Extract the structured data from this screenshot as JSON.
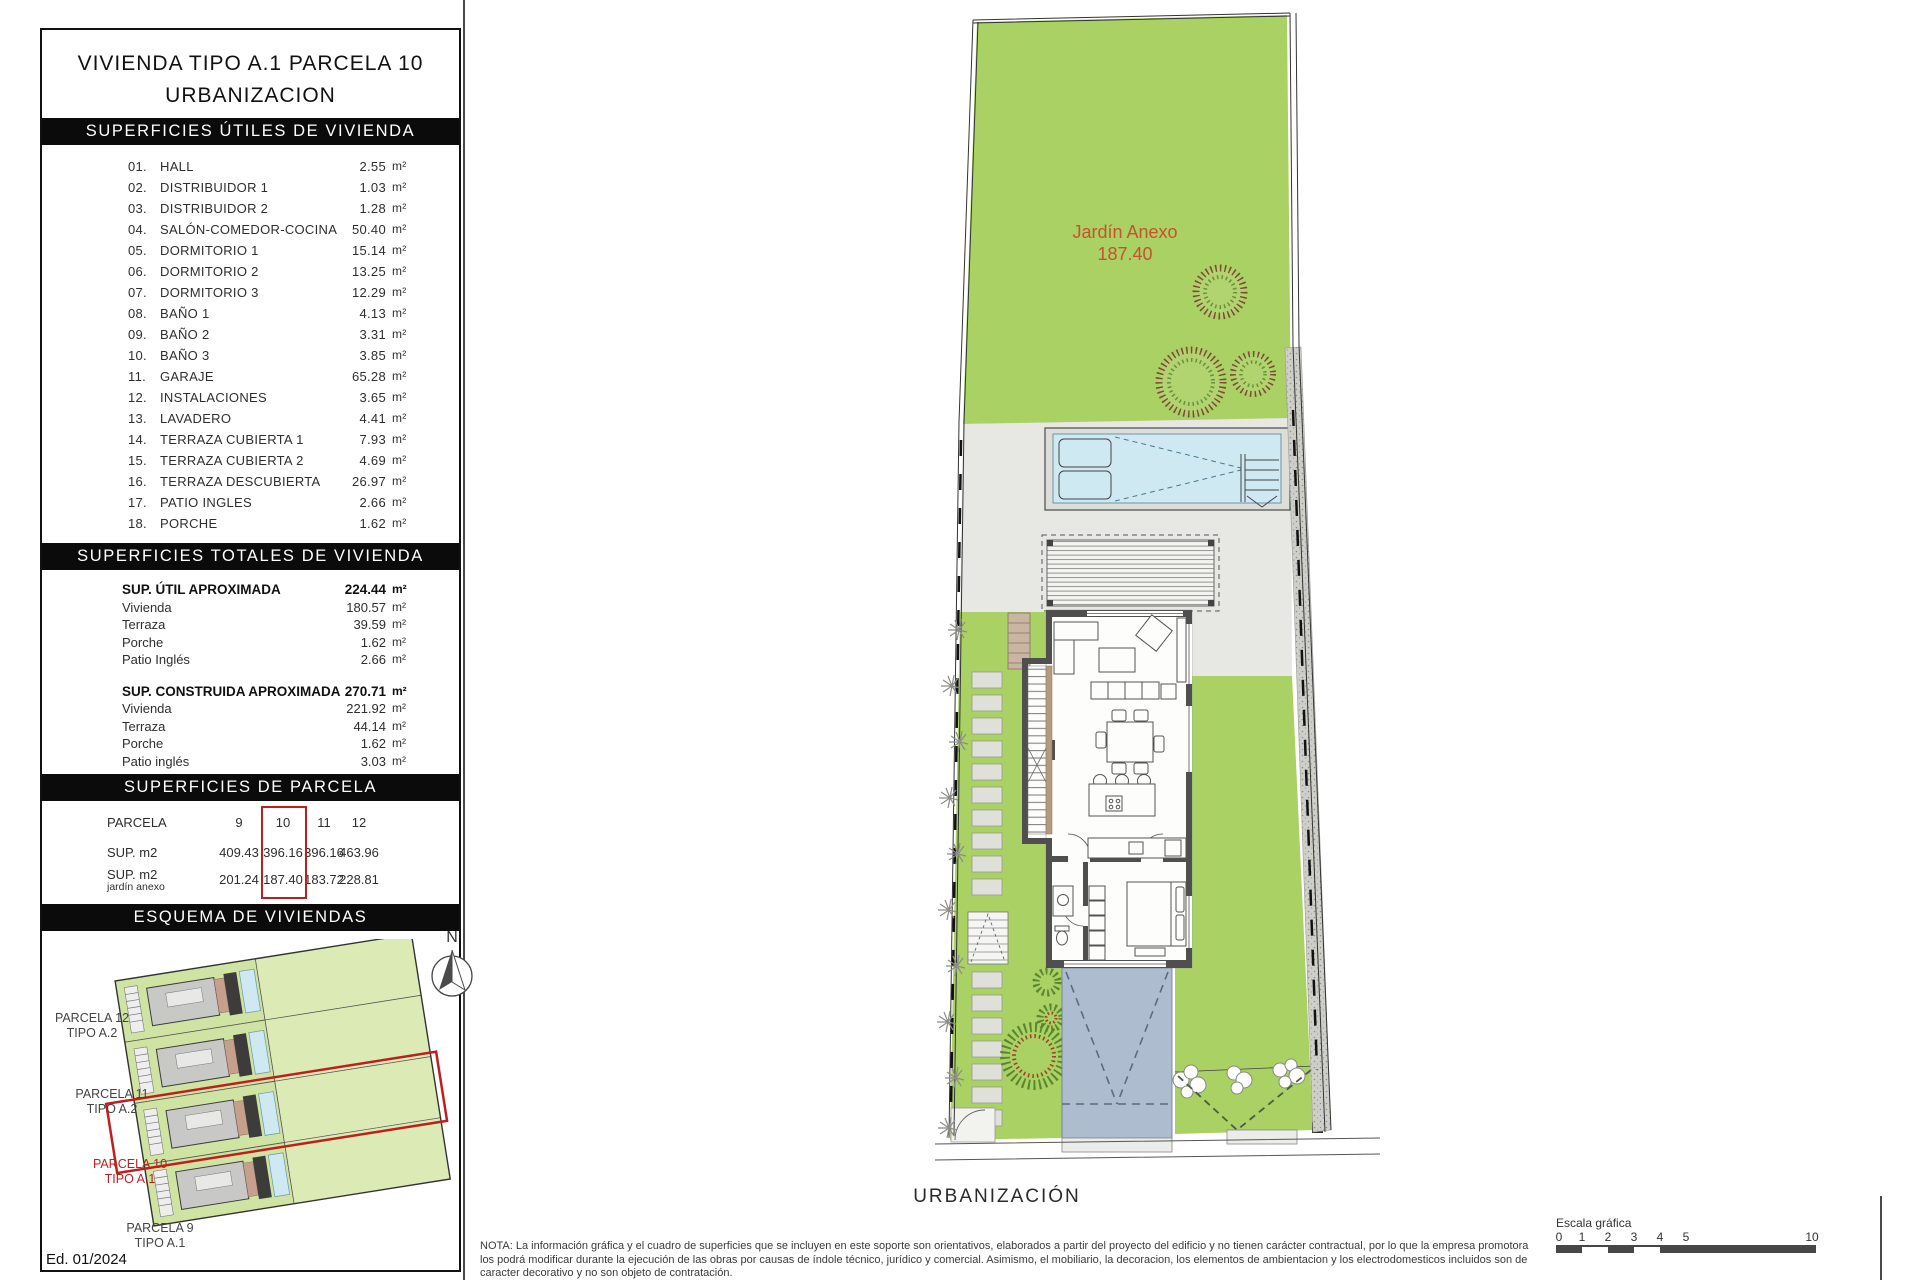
{
  "title": {
    "line1": "VIVIENDA TIPO A.1 PARCELA 10",
    "line2": "URBANIZACION"
  },
  "units": {
    "m2": "m²"
  },
  "utiles": {
    "header": "SUPERFICIES ÚTILES DE VIVIENDA",
    "rows": [
      {
        "num": "01.",
        "label": "HALL",
        "value": "2.55"
      },
      {
        "num": "02.",
        "label": "DISTRIBUIDOR 1",
        "value": "1.03"
      },
      {
        "num": "03.",
        "label": "DISTRIBUIDOR 2",
        "value": "1.28"
      },
      {
        "num": "04.",
        "label": "SALÓN-COMEDOR-COCINA",
        "value": "50.40"
      },
      {
        "num": "05.",
        "label": "DORMITORIO 1",
        "value": "15.14"
      },
      {
        "num": "06.",
        "label": "DORMITORIO 2",
        "value": "13.25"
      },
      {
        "num": "07.",
        "label": "DORMITORIO 3",
        "value": "12.29"
      },
      {
        "num": "08.",
        "label": "BAÑO 1",
        "value": "4.13"
      },
      {
        "num": "09.",
        "label": "BAÑO 2",
        "value": "3.31"
      },
      {
        "num": "10.",
        "label": "BAÑO 3",
        "value": "3.85"
      },
      {
        "num": "11.",
        "label": "GARAJE",
        "value": "65.28"
      },
      {
        "num": "12.",
        "label": "INSTALACIONES",
        "value": "3.65"
      },
      {
        "num": "13.",
        "label": "LAVADERO",
        "value": "4.41"
      },
      {
        "num": "14.",
        "label": "TERRAZA CUBIERTA 1",
        "value": "7.93"
      },
      {
        "num": "15.",
        "label": "TERRAZA CUBIERTA 2",
        "value": "4.69"
      },
      {
        "num": "16.",
        "label": "TERRAZA DESCUBIERTA",
        "value": "26.97"
      },
      {
        "num": "17.",
        "label": "PATIO INGLES",
        "value": "2.66"
      },
      {
        "num": "18.",
        "label": "PORCHE",
        "value": "1.62"
      }
    ]
  },
  "totales": {
    "header": "SUPERFICIES TOTALES DE VIVIENDA",
    "groups": [
      {
        "title": "SUP. ÚTIL APROXIMADA",
        "total": "224.44",
        "rows": [
          {
            "label": "Vivienda",
            "value": "180.57"
          },
          {
            "label": "Terraza",
            "value": "39.59"
          },
          {
            "label": "Porche",
            "value": "1.62"
          },
          {
            "label": "Patio Inglés",
            "value": "2.66"
          }
        ]
      },
      {
        "title": "SUP. CONSTRUIDA APROXIMADA",
        "total": "270.71",
        "rows": [
          {
            "label": "Vivienda",
            "value": "221.92"
          },
          {
            "label": "Terraza",
            "value": "44.14"
          },
          {
            "label": "Porche",
            "value": "1.62"
          },
          {
            "label": "Patio inglés",
            "value": "3.03"
          }
        ]
      }
    ]
  },
  "parcela": {
    "header": "SUPERFICIES DE PARCELA",
    "col_label": "PARCELA",
    "columns": [
      "9",
      "10",
      "11",
      "12"
    ],
    "row1_label": "SUP. m2",
    "row1": [
      "409.43",
      "396.16",
      "396.16",
      "463.96"
    ],
    "row2_label": "SUP. m2",
    "row2_sublabel": "jardín anexo",
    "row2": [
      "201.24",
      "187.40",
      "183.72",
      "228.81"
    ],
    "highlighted_column": "10"
  },
  "esquema": {
    "header": "ESQUEMA DE VIVIENDAS",
    "north_label": "N",
    "labels": [
      {
        "l1": "PARCELA 12",
        "l2": "TIPO A.2"
      },
      {
        "l1": "PARCELA 11",
        "l2": "TIPO A.2"
      },
      {
        "l1": "PARCELA 10",
        "l2": "TIPO A.1"
      },
      {
        "l1": "PARCELA 9",
        "l2": "TIPO A.1"
      }
    ]
  },
  "plan": {
    "garden_label": "Jardín Anexo",
    "garden_area": "187.40",
    "caption": "URBANIZACIÓN"
  },
  "footer": {
    "edition": "Ed. 01/2024",
    "note": "NOTA: La información gráfica y el cuadro de superficies que se incluyen en este soporte son orientativos, elaborados a partir del proyecto del edificio y no tienen carácter contractual, por lo que la empresa promotora los podrá modificar durante la ejecución de las obras por causas de índole técnico, jurídico y comercial. Asimismo, el mobiliario, la decoracion, los elementos de ambientacion y los electrodomesticos incluidos son de caracter decorativo y no son objeto de contratación.",
    "scale_label": "Escala gráfica",
    "scale_ticks": [
      "0",
      "1",
      "2",
      "3",
      "4",
      "5",
      "10"
    ]
  },
  "colors": {
    "garden_green": "#a9d163",
    "pool_blue": "#cfe9f2",
    "driveway_blue": "#aebccf",
    "accent_red": "#c21d1d",
    "garden_text_orange": "#c8512e"
  }
}
